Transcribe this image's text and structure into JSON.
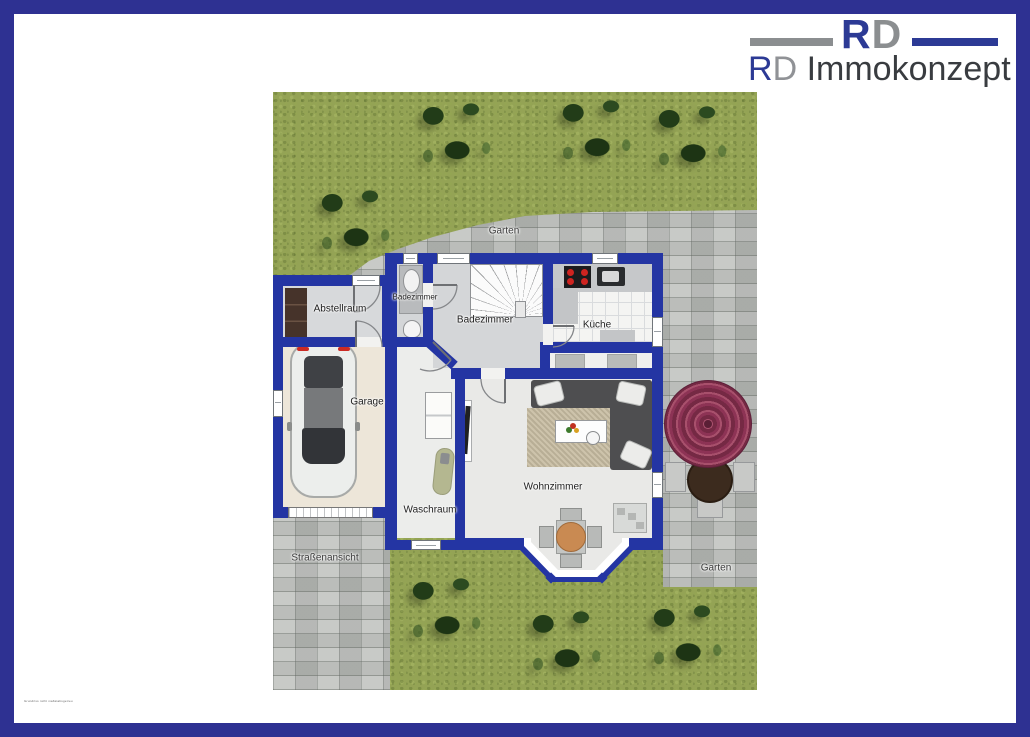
{
  "logo": {
    "monogram_r": "R",
    "monogram_d": "D",
    "company_r": "R",
    "company_d": "D",
    "company_rest": " Immokonzept"
  },
  "rooms": {
    "abstellraum": "Abstellraum",
    "badezimmer_klein": "Badezimmer",
    "badezimmer": "Badezimmer",
    "kueche": "Küche",
    "garage": "Garage",
    "waschraum": "Waschraum",
    "wohnzimmer": "Wohnzimmer"
  },
  "outdoor": {
    "garten_top": "Garten",
    "garten_bottom": "Garten",
    "street": "Straßenansicht"
  },
  "fine_print": "Grundriss nicht maßstabsgetreu",
  "colors": {
    "frame_border": "#2e3192",
    "wall_blue": "#2435a3",
    "logo_blue": "#2c3a95",
    "logo_gray": "#8b8e90",
    "grass_green": "#94a355",
    "paving_gray": "#bdc0bc",
    "garage_floor": "#ede6d9",
    "parasol_maroon": "#8d3355",
    "table_brown": "#3c2b1e"
  }
}
